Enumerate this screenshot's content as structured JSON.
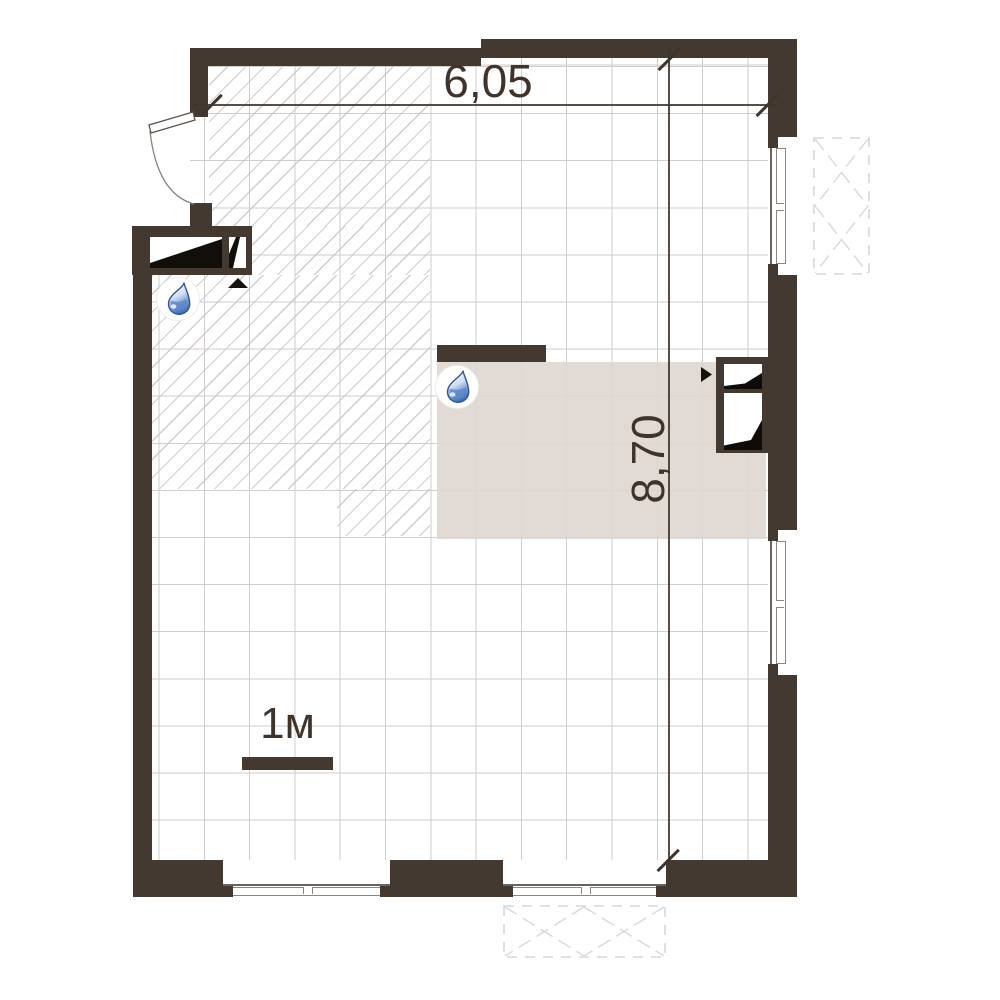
{
  "title": "apartment-floor-plan",
  "dimensions": {
    "width_label": "6,05",
    "height_label": "8,70"
  },
  "scale_bar": {
    "label": "1м"
  },
  "colors": {
    "wall": "#443931",
    "text": "#3e342c",
    "grid_line": "#d0cdcb",
    "hatch_line": "#c9c4c1",
    "zone_fill": "#ded6d0",
    "dashed_symbol": "#d4d9dd",
    "window_frame": "#8d8680",
    "drop_outline": "#2d539b",
    "drop_fill": "#6d95d2"
  },
  "icons": {
    "water_drop": "water-drop-icon",
    "entrance_door": "door-swing-icon",
    "vent_shaft": "vent-shaft-icon",
    "balcony_marker": "dashed-x-box-icon",
    "direction_triangle": "triangle-marker-icon"
  }
}
